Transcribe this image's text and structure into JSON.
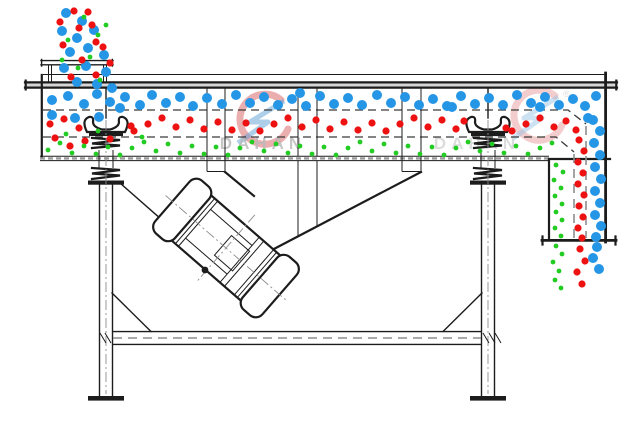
{
  "diagram": {
    "name": "linear-vibrating-screen-cross-section",
    "parts": {
      "feed_inlet": "feed-inlet",
      "screen_body": "screen-body",
      "deck_1": "upper-screen-deck",
      "deck_2": "lower-screen-deck",
      "discharge_chute": "discharge-chute",
      "vibration_motor": "vibration-motor",
      "spring_left": "support-spring-left",
      "spring_right": "support-spring-right",
      "frame": "support-frame"
    }
  },
  "watermark": {
    "text": "DAHAN",
    "registered": "®"
  },
  "colors": {
    "line": "#1c1c1c",
    "background": "#ffffff",
    "coarse_blue": "#2596e6",
    "medium_red": "#ee1111",
    "fine_green": "#22cc22",
    "hatch_gray": "#9b9b9b",
    "dash_gray": "#8d8d8d",
    "watermark_gray": "#b9b9b9",
    "watermark_red": "#d24b4b",
    "watermark_blue": "#5b9fd6"
  },
  "particles": {
    "groups": [
      {
        "name": "coarse-blue",
        "color": "#2596e6",
        "r": 5,
        "points": [
          [
            52,
            100
          ],
          [
            68,
            96
          ],
          [
            84,
            104
          ],
          [
            97,
            94
          ],
          [
            110,
            102
          ],
          [
            125,
            97
          ],
          [
            140,
            105
          ],
          [
            152,
            95
          ],
          [
            166,
            103
          ],
          [
            180,
            97
          ],
          [
            193,
            106
          ],
          [
            207,
            98
          ],
          [
            222,
            104
          ],
          [
            236,
            95
          ],
          [
            250,
            103
          ],
          [
            264,
            97
          ],
          [
            278,
            105
          ],
          [
            292,
            99
          ],
          [
            306,
            106
          ],
          [
            320,
            96
          ],
          [
            334,
            104
          ],
          [
            348,
            98
          ],
          [
            362,
            105
          ],
          [
            377,
            95
          ],
          [
            391,
            103
          ],
          [
            405,
            97
          ],
          [
            419,
            105
          ],
          [
            433,
            99
          ],
          [
            447,
            106
          ],
          [
            461,
            96
          ],
          [
            475,
            104
          ],
          [
            489,
            98
          ],
          [
            503,
            105
          ],
          [
            517,
            95
          ],
          [
            531,
            103
          ],
          [
            545,
            97
          ],
          [
            559,
            105
          ],
          [
            573,
            99
          ],
          [
            585,
            106
          ],
          [
            596,
            96
          ],
          [
            120,
            108
          ],
          [
            300,
            93
          ],
          [
            452,
            107
          ],
          [
            540,
            107
          ],
          [
            588,
            118
          ],
          [
            52,
            115
          ],
          [
            75,
            118
          ],
          [
            99,
            117
          ],
          [
            593,
            120
          ],
          [
            600,
            131
          ],
          [
            594,
            143
          ],
          [
            600,
            155
          ],
          [
            595,
            167
          ],
          [
            601,
            179
          ],
          [
            595,
            191
          ],
          [
            600,
            203
          ],
          [
            595,
            215
          ],
          [
            601,
            226
          ],
          [
            596,
            237
          ],
          [
            597,
            247
          ],
          [
            593,
            258
          ],
          [
            599,
            269
          ],
          [
            66,
            13
          ],
          [
            82,
            21
          ],
          [
            62,
            31
          ],
          [
            77,
            38
          ],
          [
            94,
            30
          ],
          [
            70,
            52
          ],
          [
            88,
            48
          ],
          [
            104,
            55
          ],
          [
            64,
            68
          ],
          [
            86,
            66
          ],
          [
            106,
            72
          ],
          [
            77,
            82
          ],
          [
            97,
            84
          ],
          [
            112,
            88
          ]
        ]
      },
      {
        "name": "medium-red",
        "color": "#ee1111",
        "r": 3.6,
        "points": [
          [
            50,
            124
          ],
          [
            64,
            119
          ],
          [
            79,
            128
          ],
          [
            131,
            126
          ],
          [
            134,
            131
          ],
          [
            148,
            124
          ],
          [
            162,
            118
          ],
          [
            176,
            127
          ],
          [
            190,
            120
          ],
          [
            204,
            129
          ],
          [
            218,
            122
          ],
          [
            232,
            130
          ],
          [
            246,
            123
          ],
          [
            260,
            131
          ],
          [
            274,
            124
          ],
          [
            288,
            118
          ],
          [
            302,
            127
          ],
          [
            316,
            120
          ],
          [
            330,
            129
          ],
          [
            344,
            122
          ],
          [
            358,
            130
          ],
          [
            372,
            123
          ],
          [
            386,
            131
          ],
          [
            400,
            124
          ],
          [
            414,
            118
          ],
          [
            428,
            127
          ],
          [
            442,
            120
          ],
          [
            456,
            129
          ],
          [
            464,
            121
          ],
          [
            506,
            128
          ],
          [
            512,
            131
          ],
          [
            526,
            124
          ],
          [
            540,
            118
          ],
          [
            554,
            127
          ],
          [
            566,
            121
          ],
          [
            576,
            130
          ],
          [
            55,
            138
          ],
          [
            85,
            141
          ],
          [
            70,
            146
          ],
          [
            110,
            139
          ],
          [
            579,
            140
          ],
          [
            584,
            151
          ],
          [
            578,
            162
          ],
          [
            583,
            173
          ],
          [
            578,
            184
          ],
          [
            584,
            195
          ],
          [
            579,
            206
          ],
          [
            583,
            217
          ],
          [
            578,
            228
          ],
          [
            582,
            238
          ],
          [
            580,
            249
          ],
          [
            585,
            261
          ],
          [
            577,
            272
          ],
          [
            582,
            284
          ],
          [
            74,
            11
          ],
          [
            92,
            25
          ],
          [
            79,
            28
          ],
          [
            63,
            45
          ],
          [
            96,
            42
          ],
          [
            82,
            60
          ],
          [
            71,
            77
          ],
          [
            96,
            75
          ],
          [
            88,
            12
          ],
          [
            60,
            22
          ],
          [
            103,
            47
          ],
          [
            110,
            63
          ]
        ]
      },
      {
        "name": "fine-green",
        "color": "#22cc22",
        "r": 2.4,
        "points": [
          [
            48,
            150
          ],
          [
            60,
            143
          ],
          [
            72,
            153
          ],
          [
            84,
            146
          ],
          [
            96,
            154
          ],
          [
            108,
            147
          ],
          [
            120,
            155
          ],
          [
            132,
            148
          ],
          [
            144,
            142
          ],
          [
            156,
            151
          ],
          [
            168,
            144
          ],
          [
            180,
            153
          ],
          [
            192,
            146
          ],
          [
            204,
            154
          ],
          [
            216,
            147
          ],
          [
            228,
            155
          ],
          [
            240,
            148
          ],
          [
            252,
            142
          ],
          [
            264,
            151
          ],
          [
            276,
            144
          ],
          [
            288,
            153
          ],
          [
            300,
            146
          ],
          [
            312,
            154
          ],
          [
            324,
            147
          ],
          [
            336,
            155
          ],
          [
            348,
            148
          ],
          [
            360,
            142
          ],
          [
            372,
            151
          ],
          [
            384,
            144
          ],
          [
            396,
            153
          ],
          [
            408,
            146
          ],
          [
            420,
            154
          ],
          [
            432,
            147
          ],
          [
            444,
            155
          ],
          [
            456,
            148
          ],
          [
            468,
            142
          ],
          [
            480,
            151
          ],
          [
            492,
            144
          ],
          [
            504,
            153
          ],
          [
            516,
            146
          ],
          [
            528,
            154
          ],
          [
            540,
            148
          ],
          [
            552,
            143
          ],
          [
            66,
            134
          ],
          [
            98,
            131
          ],
          [
            142,
            137
          ],
          [
            556,
            165
          ],
          [
            563,
            172
          ],
          [
            554,
            180
          ],
          [
            561,
            188
          ],
          [
            555,
            196
          ],
          [
            562,
            204
          ],
          [
            556,
            212
          ],
          [
            562,
            220
          ],
          [
            555,
            228
          ],
          [
            561,
            236
          ],
          [
            556,
            246
          ],
          [
            562,
            254
          ],
          [
            553,
            262
          ],
          [
            559,
            271
          ],
          [
            555,
            280
          ],
          [
            561,
            288
          ],
          [
            84,
            17
          ],
          [
            98,
            35
          ],
          [
            68,
            40
          ],
          [
            90,
            57
          ],
          [
            78,
            68
          ],
          [
            100,
            80
          ],
          [
            62,
            60
          ],
          [
            106,
            25
          ]
        ]
      }
    ]
  }
}
